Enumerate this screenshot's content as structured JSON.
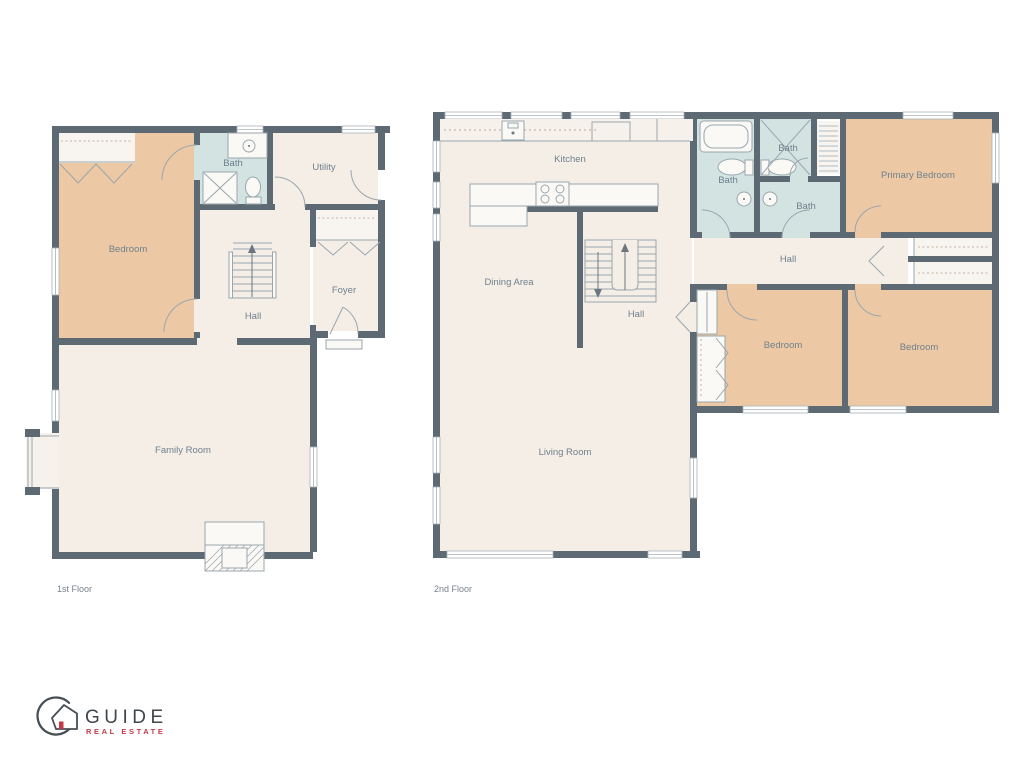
{
  "colors": {
    "wall": "#5d6a73",
    "floor": "#f4eee7",
    "bedroom_fill": "#ecc9a4",
    "bath_fill": "#d2e3e2",
    "label_text": "#71808c",
    "logo_text": "#3f464c",
    "logo_red": "#c23a45"
  },
  "floor1": {
    "label": "1st Floor",
    "rooms": {
      "bedroom": "Bedroom",
      "bath": "Bath",
      "utility": "Utility",
      "hall": "Hall",
      "foyer": "Foyer",
      "family_room": "Family Room"
    }
  },
  "floor2": {
    "label": "2nd Floor",
    "rooms": {
      "kitchen": "Kitchen",
      "dining_area": "Dining Area",
      "stair_hall": "Hall",
      "living_room": "Living Room",
      "bath_left": "Bath",
      "bath_shower": "Bath",
      "bath_middle": "Bath",
      "primary_bedroom": "Primary Bedroom",
      "hall": "Hall",
      "bedroom_left": "Bedroom",
      "bedroom_right": "Bedroom"
    }
  },
  "logo": {
    "name": "GUIDE",
    "tagline": "REAL ESTATE"
  }
}
